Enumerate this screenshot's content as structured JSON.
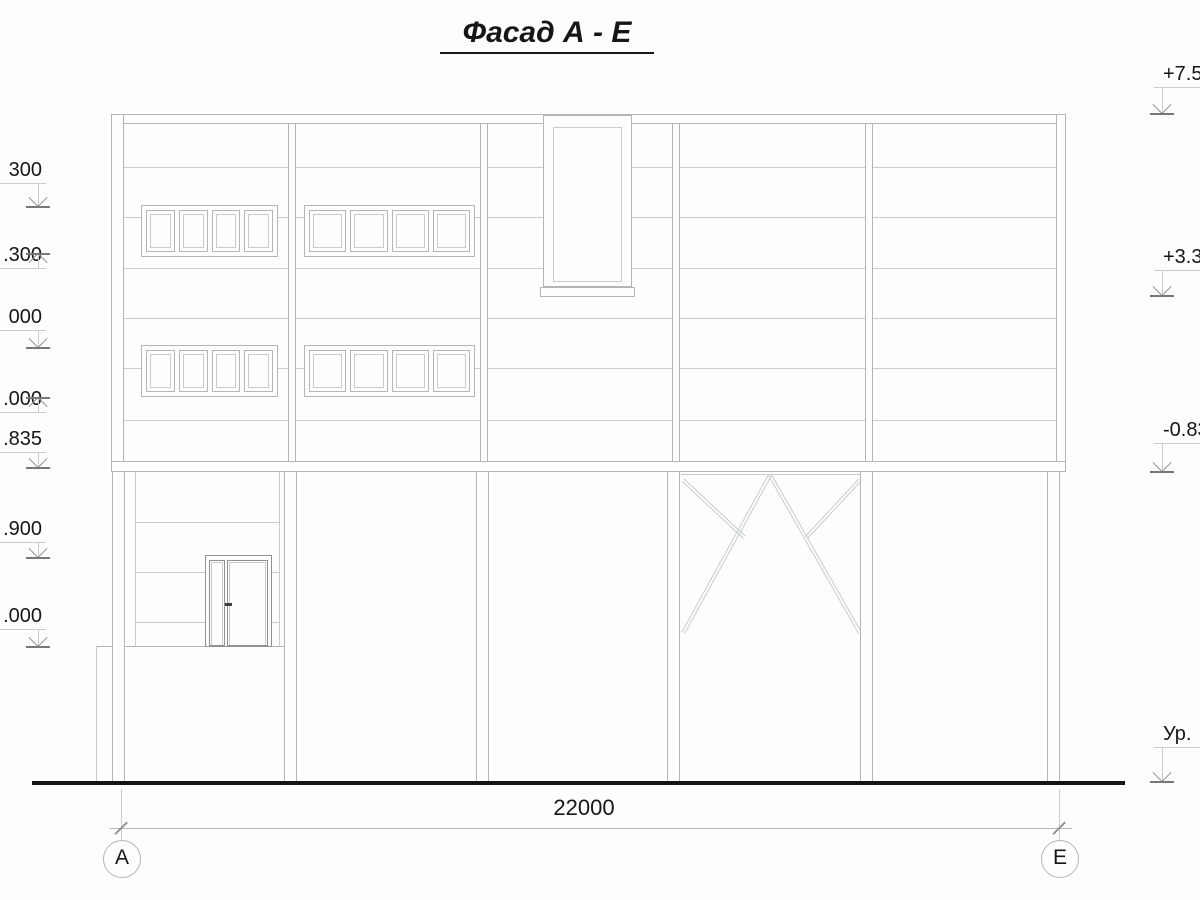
{
  "title": "Фасад А - Е",
  "dimension": {
    "total_width": "22000"
  },
  "axis_bubbles": {
    "left": "А",
    "right": "Е"
  },
  "elevation_marks": {
    "left": [
      {
        "label": "300",
        "arrow": "down"
      },
      {
        "label": ".300",
        "arrow": "up"
      },
      {
        "label": "000",
        "arrow": "down"
      },
      {
        "label": ".000",
        "arrow": "up"
      },
      {
        "label": ".835",
        "arrow": "down"
      },
      {
        "label": ".900",
        "arrow": "down"
      },
      {
        "label": ".000",
        "arrow": "down"
      }
    ],
    "right": [
      {
        "label": "+7.500",
        "arrow": "down"
      },
      {
        "label": "+3.300",
        "arrow": "down"
      },
      {
        "label": "-0.835",
        "arrow": "down"
      },
      {
        "label": "Ур.",
        "arrow": "down"
      }
    ]
  },
  "colors": {
    "line": "#b3b6b8",
    "line_light": "#c9cccd",
    "line_dark": "#8e9294",
    "base_line": "#74787a",
    "ink": "#161616",
    "ground": "#141414"
  }
}
